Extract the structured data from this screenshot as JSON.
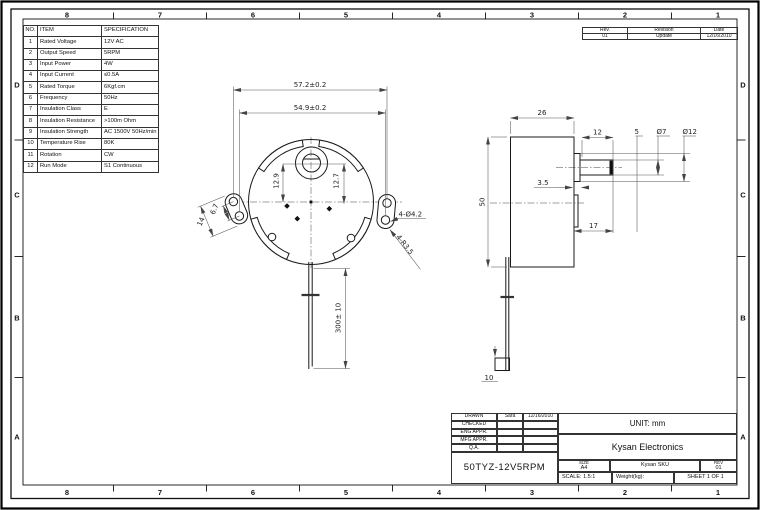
{
  "sheet": {
    "part_number": "50TYZ-12V5RPM",
    "company": "Kysan Electronics",
    "unit": "UNIT: mm"
  },
  "border": {
    "columns": [
      "8",
      "7",
      "6",
      "5",
      "4",
      "3",
      "2",
      "1"
    ],
    "rows": [
      "D",
      "C",
      "B",
      "A"
    ]
  },
  "spec_table": {
    "headers": [
      "NO.",
      "ITEM",
      "SPECIFICATION"
    ],
    "rows": [
      [
        "1",
        "Rated Voltage",
        "12V AC"
      ],
      [
        "2",
        "Output Speed",
        "5RPM"
      ],
      [
        "3",
        "Input Power",
        "4W"
      ],
      [
        "4",
        "Input Current",
        "≤0.5A"
      ],
      [
        "5",
        "Rated Torque",
        "6Kgf.cm"
      ],
      [
        "6",
        "Frequency",
        "50Hz"
      ],
      [
        "7",
        "Insulation Class",
        "E"
      ],
      [
        "8",
        "Insulation Resistance",
        ">100m Ohm"
      ],
      [
        "9",
        "Insulation Strength",
        "AC 1500V 50Hz/min"
      ],
      [
        "10",
        "Temperature Rise",
        "80K"
      ],
      [
        "11",
        "Rotation",
        "CW"
      ],
      [
        "12",
        "Run Mode",
        "S1 Continuous"
      ]
    ]
  },
  "revision_block": {
    "headers": [
      "Rev.",
      "Revision",
      "Date"
    ],
    "entry": {
      "rev": "01",
      "revision": "Update",
      "date": "12/16/2010"
    }
  },
  "title_block": {
    "approvals": [
      {
        "label": "DRAWN",
        "name": "Sara",
        "date": "12/16/2010"
      },
      {
        "label": "CHECKED",
        "name": "",
        "date": ""
      },
      {
        "label": "ENG APPR.",
        "name": "",
        "date": ""
      },
      {
        "label": "MFG APPR.",
        "name": "",
        "date": ""
      },
      {
        "label": "Q.A.",
        "name": "",
        "date": ""
      }
    ],
    "size_label": "SIZE",
    "size_value": "A4",
    "sku_label": "Kysan SKU",
    "rev_label": "REV",
    "rev_value": "01",
    "scale": "SCALE: 1.5:1",
    "weight": "Weight(kg):",
    "sheet": "SHEET 1 OF 1"
  },
  "dimensions": {
    "front": {
      "overall_width": "57.2±0.2",
      "hole_span": "54.9±0.2",
      "offset_left": "12.9",
      "offset_right": "12.7",
      "ear_hole_pitch": "6.7",
      "ear_length": "14",
      "mount_holes": "4-Ø4.2",
      "ear_radius": "4-R3.5",
      "lead_length": "300± 10"
    },
    "side": {
      "body_depth": "26",
      "body_diameter": "50",
      "shaft_length": "12",
      "shaft_tip": "5",
      "shaft_dia": "Ø7",
      "boss_dia": "Ø12",
      "boss_length": "3.5",
      "shaft_total": "17",
      "connector_height": "10"
    }
  }
}
